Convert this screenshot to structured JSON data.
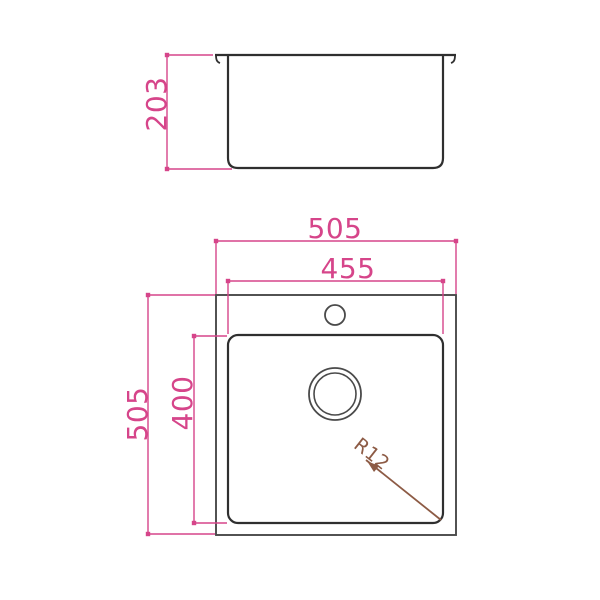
{
  "colors": {
    "background": "#ffffff",
    "outline": "#2f2f2f",
    "rim_outline": "#4a4a4a",
    "dimension": "#d6458a",
    "radius": "#8d5b45"
  },
  "side_view": {
    "depth_label": "203"
  },
  "plan_view": {
    "overall_width_label": "505",
    "bowl_width_label": "455",
    "overall_depth_label": "505",
    "bowl_depth_label": "400",
    "corner_radius_label": "R12"
  }
}
